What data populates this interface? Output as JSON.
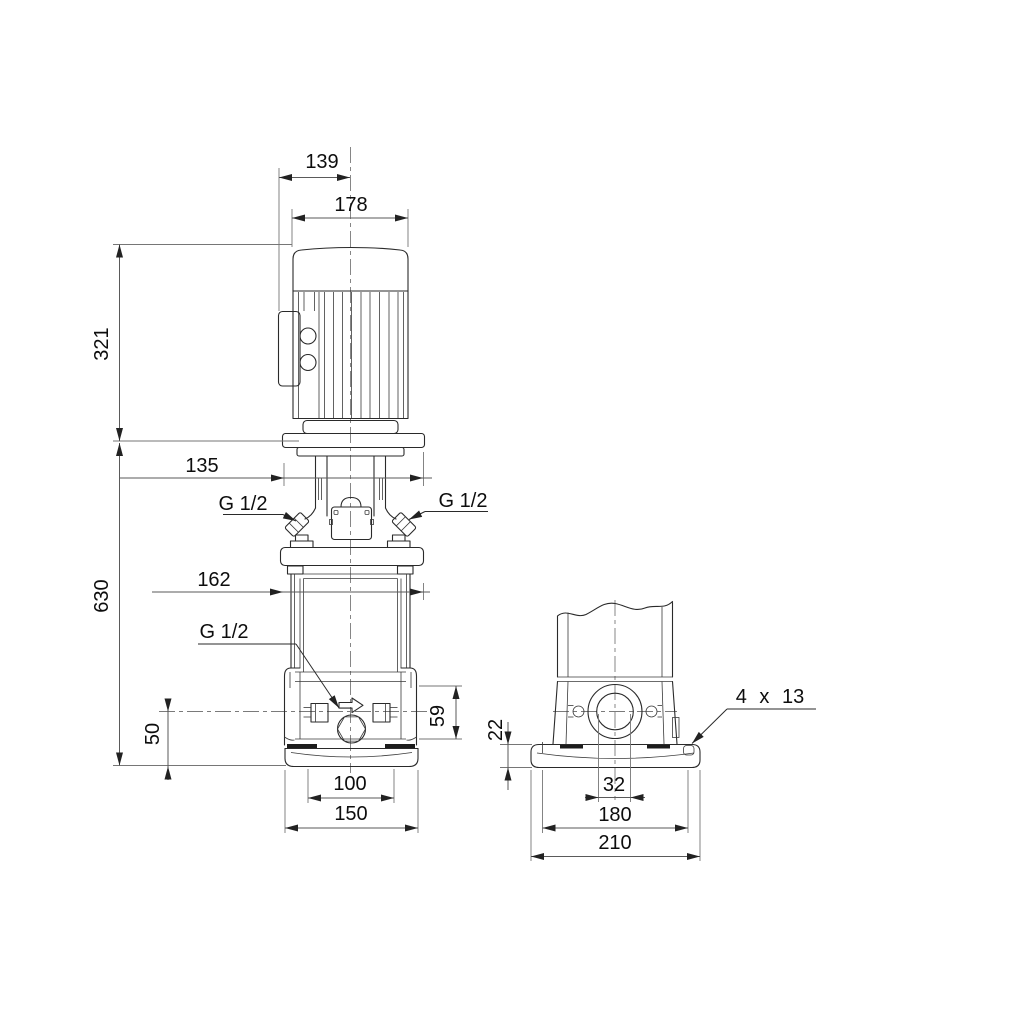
{
  "drawing": {
    "kind": "pump-dimensional-drawing",
    "background": "#ffffff",
    "line_color": "#2a2a2a",
    "dim_color": "#5a5a5a",
    "front_view": {
      "dims": {
        "motor_top_width": "139",
        "motor_width": "178",
        "motor_height": "321",
        "head_width": "135",
        "pump_height": "630",
        "sleeve_width": "162",
        "port_left": "G 1/2",
        "port_right": "G 1/2",
        "drain_port": "G 1/2",
        "center_to_base": "50",
        "port_height": "59",
        "foot_hole_spacing": "100",
        "foot_width": "150"
      }
    },
    "side_view": {
      "dims": {
        "base_plate_height": "22",
        "port_bore": "32",
        "bolt_hole_spacing": "180",
        "base_depth": "210",
        "bolt_holes": "4 x 13"
      }
    }
  }
}
